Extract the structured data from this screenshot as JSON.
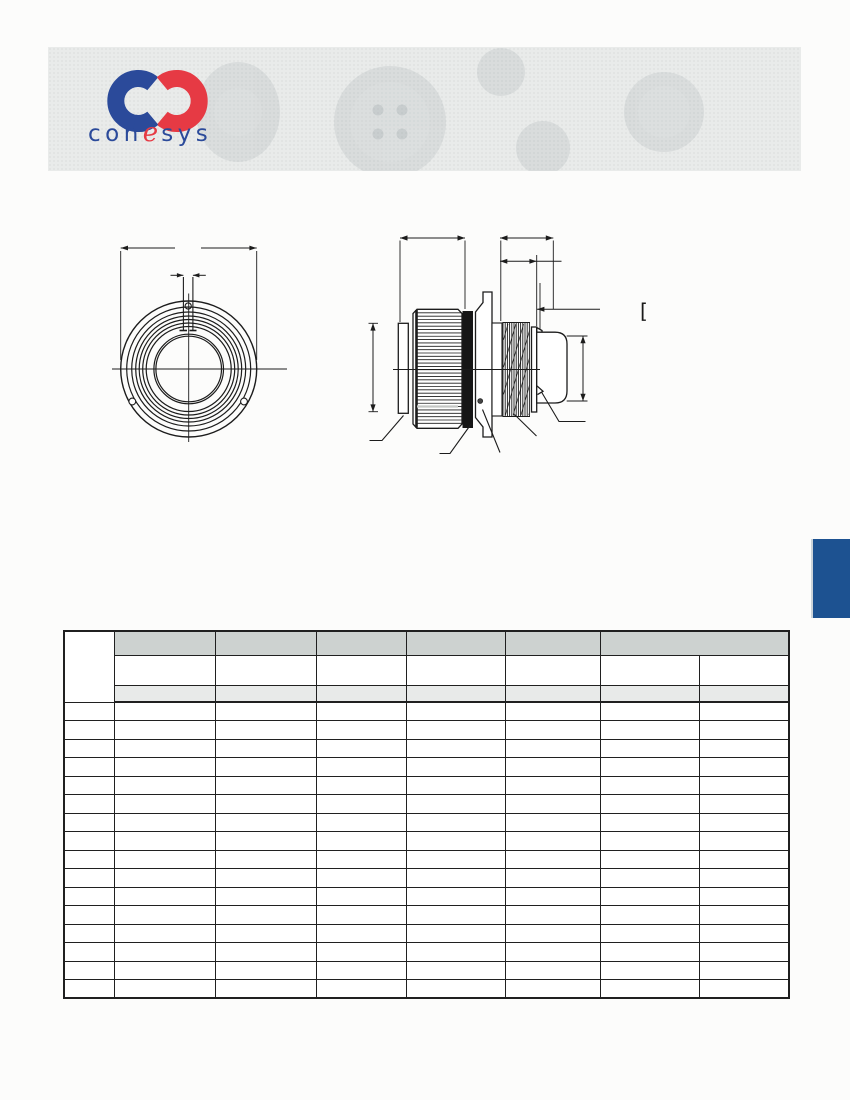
{
  "page": {
    "background": "#fcfcfb"
  },
  "banner": {
    "background": "#e9ebea"
  },
  "logo": {
    "con": "con",
    "e": "e",
    "sys": "sys",
    "blue": "#2b4a9a",
    "red": "#e63a44"
  },
  "drawing": {
    "stroke_color": "#1c1c1c",
    "bracket_glyph": "["
  },
  "side_tab": {
    "color": "#1d5291"
  },
  "table": {
    "left": 63,
    "top": 630,
    "border_color": "#202020",
    "column_widths": [
      50,
      101,
      101,
      90,
      99,
      95,
      99,
      90
    ],
    "header": {
      "stub": "",
      "row1": {
        "height": 24,
        "bg": "#cdd2d0",
        "cells": [
          "",
          "",
          "",
          "",
          "",
          ""
        ]
      },
      "row2": {
        "height": 30,
        "bg": "#ffffff",
        "cells": [
          "",
          "",
          "",
          "",
          "",
          "",
          ""
        ]
      },
      "row3": {
        "height": 17,
        "bg": "#e8eae9",
        "cells": [
          "",
          "",
          "",
          "",
          "",
          "",
          ""
        ]
      }
    },
    "rows": [
      [
        "",
        "",
        "",
        "",
        "",
        "",
        "",
        ""
      ],
      [
        "",
        "",
        "",
        "",
        "",
        "",
        "",
        ""
      ],
      [
        "",
        "",
        "",
        "",
        "",
        "",
        "",
        ""
      ],
      [
        "",
        "",
        "",
        "",
        "",
        "",
        "",
        ""
      ],
      [
        "",
        "",
        "",
        "",
        "",
        "",
        "",
        ""
      ],
      [
        "",
        "",
        "",
        "",
        "",
        "",
        "",
        ""
      ],
      [
        "",
        "",
        "",
        "",
        "",
        "",
        "",
        ""
      ],
      [
        "",
        "",
        "",
        "",
        "",
        "",
        "",
        ""
      ],
      [
        "",
        "",
        "",
        "",
        "",
        "",
        "",
        ""
      ],
      [
        "",
        "",
        "",
        "",
        "",
        "",
        "",
        ""
      ],
      [
        "",
        "",
        "",
        "",
        "",
        "",
        "",
        ""
      ],
      [
        "",
        "",
        "",
        "",
        "",
        "",
        "",
        ""
      ],
      [
        "",
        "",
        "",
        "",
        "",
        "",
        "",
        ""
      ],
      [
        "",
        "",
        "",
        "",
        "",
        "",
        "",
        ""
      ],
      [
        "",
        "",
        "",
        "",
        "",
        "",
        "",
        ""
      ],
      [
        "",
        "",
        "",
        "",
        "",
        "",
        "",
        ""
      ]
    ]
  }
}
